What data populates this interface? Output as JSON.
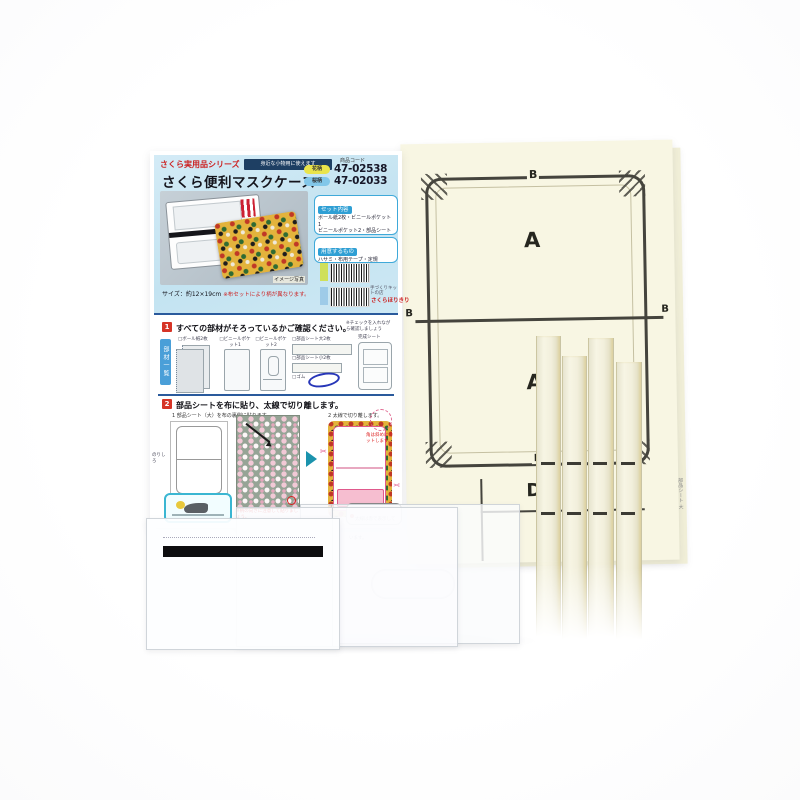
{
  "package": {
    "series_label": "さくら実用品シリーズ",
    "banner_note": "身近な小物用に使えます",
    "title": "さくら便利マスクケース",
    "photo_caption": "イメージ写真",
    "size_note": "サイズ：約12×19cm",
    "size_note_red": "※布セットにより柄が異なります。",
    "code_heading": "商品コード",
    "codes": [
      {
        "variant": "花柄",
        "value": "47-02538",
        "badge_color": "#e9e44b"
      },
      {
        "variant": "桜柄",
        "value": "47-02033",
        "badge_color": "#82c7e9"
      }
    ],
    "set_box": {
      "heading": "セット内容",
      "lines": [
        "ボール紙2枚・ビニールポケット1",
        "ビニールポケット2・部品シート大2枚",
        "部品シート小2枚・完成シート",
        "・ゴム"
      ]
    },
    "prepare_box": {
      "heading": "用意するもの",
      "lines": [
        "ハサミ・布用テープ・定規",
        "ボンドタッチ（ボンド）・鉛筆"
      ]
    },
    "maker_note": "手づくりキットの店",
    "maker": "さくらほりきり",
    "step1": {
      "number": "1",
      "heading": "すべての部材がそろっているかご確認ください。",
      "side_note": "※チェックを入れながら確認しましょう",
      "parts_list_label": "部材一覧",
      "part_labels": [
        "□ボール紙2枚",
        "□ビニールポケット1",
        "□ビニールポケット2",
        "□部品シート大2枚",
        "□部品シート小2枚",
        "□ゴム",
        "完成シート"
      ]
    },
    "step2": {
      "number": "2",
      "heading": "部品シートを布に貼り、太線で切り離します。",
      "sub1": "1 部品シート（大）を布の裏側に貼ります。",
      "sub2": "2 太線で切り離します。",
      "glue_note": "のりしろ",
      "fabric_note": "※柄の向きに注意して貼りましょう。",
      "circle_note": "角は斜めにカットします。",
      "bubble_note": "太線は赤で表示しています。",
      "scissors_icon": "✂"
    }
  },
  "pattern_sheet": {
    "labels": {
      "top_b": "B",
      "upper_a": "A",
      "left_b": "B",
      "right_b": "B",
      "bottom_b": "B",
      "lower_a": "A",
      "d": "D"
    },
    "edge_text": "部品シート 大"
  },
  "colors": {
    "package_blue": "#c9e7f4",
    "navy": "#1e3f63",
    "accent_red": "#d63426",
    "sky_blue": "#3fa9d9",
    "cream": "#f8f6e3",
    "line_dark": "#45443d",
    "pink": "#e0598c",
    "teal": "#1b93ad",
    "rubber_blue": "#2736b8"
  }
}
